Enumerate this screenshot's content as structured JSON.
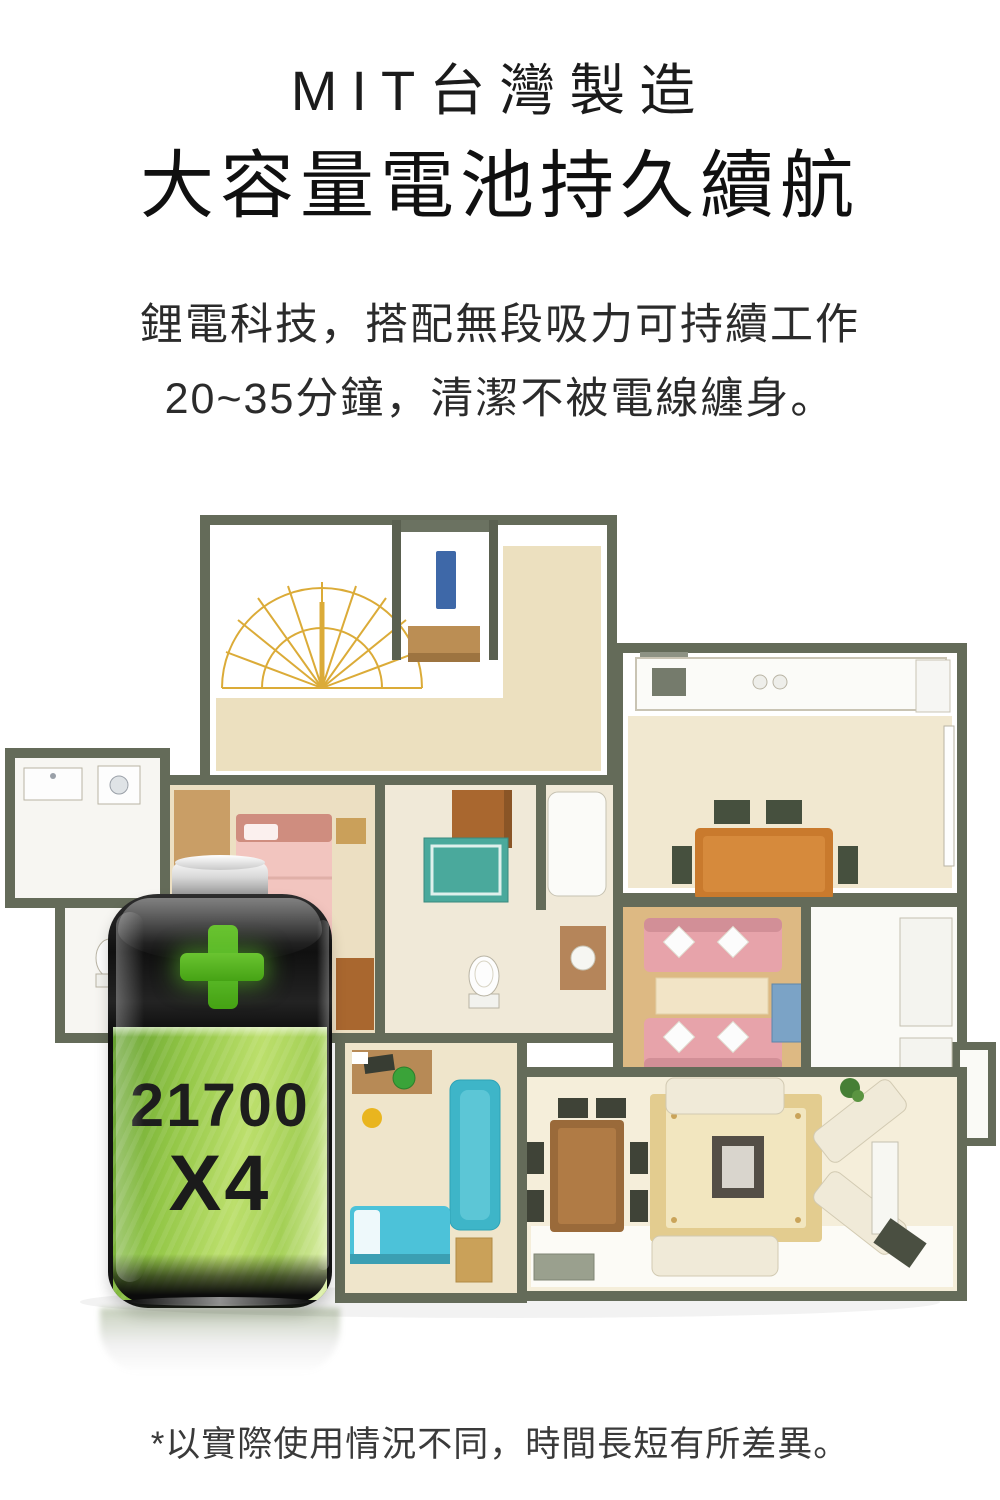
{
  "page": {
    "background": "#ffffff"
  },
  "header": {
    "tagline": "MIT台灣製造",
    "title": "大容量電池持久續航",
    "description": [
      "鋰電科技，搭配無段吸力可持續工作",
      "20~35分鐘，清潔不被電線纏身。"
    ]
  },
  "battery": {
    "cell_model": "21700",
    "cell_count": "X4",
    "colors": {
      "body_green": "#92c646",
      "plus_green": "#54b224",
      "shell_black": "#141414",
      "cap_silver": "#d8d8d8"
    }
  },
  "floorplan_colors": {
    "wall": "#646b59",
    "floor_beige": "#eee3c6",
    "floor_wood": "#ddb983",
    "sofa_pink": "#e7a3aa",
    "sofa_cream": "#f0ead8",
    "table_orange": "#c97a2d",
    "mat_blue": "#3eb5c8",
    "rug_yellow": "#e3cc8f",
    "stairs_yellow": "#d8a323"
  },
  "footnote": "*以實際使用情況不同，時間長短有所差異。"
}
